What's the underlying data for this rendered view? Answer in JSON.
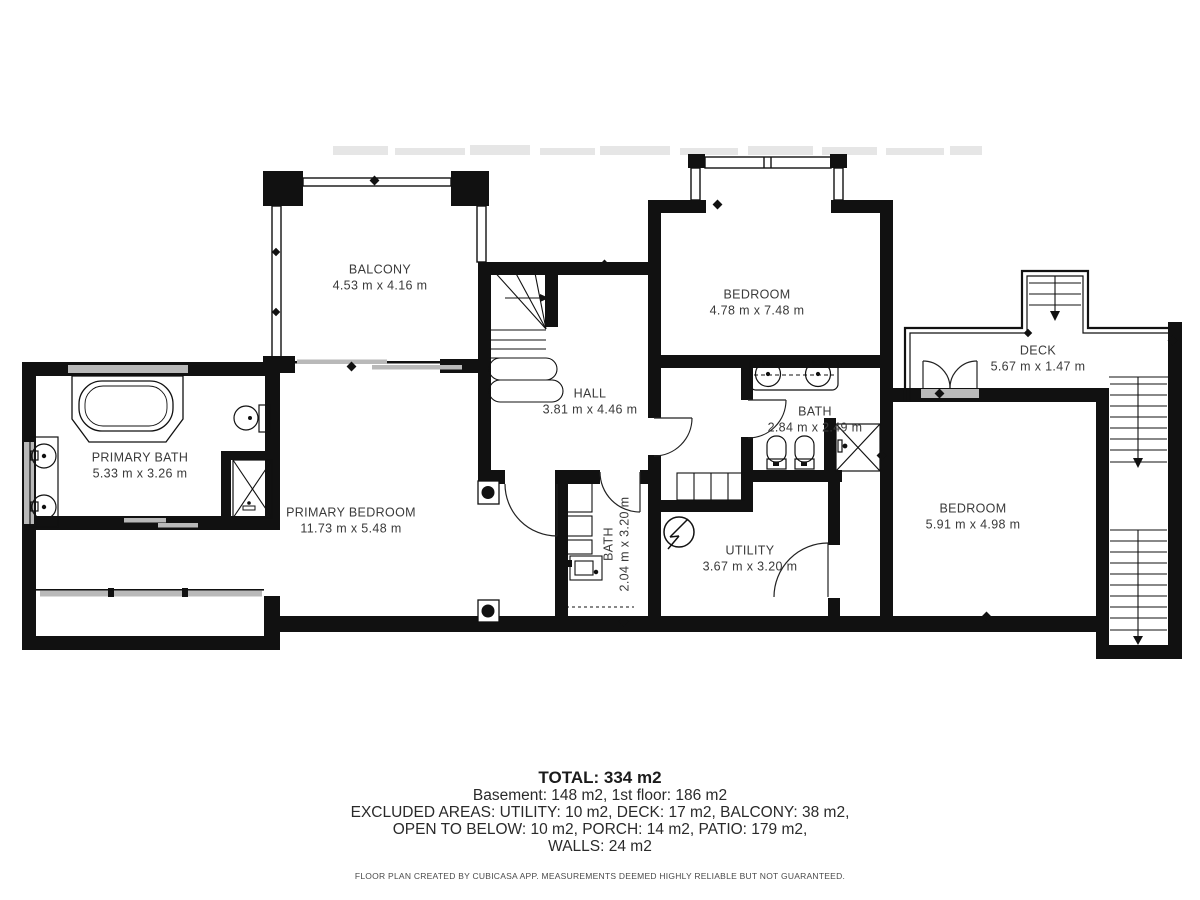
{
  "rooms": {
    "balcony": {
      "label": "BALCONY",
      "dims": "4.53 m x 4.16 m"
    },
    "hall": {
      "label": "HALL",
      "dims": "3.81 m x 4.46 m"
    },
    "bedroom_top": {
      "label": "BEDROOM",
      "dims": "4.78 m x 7.48 m"
    },
    "deck": {
      "label": "DECK",
      "dims": "5.67 m x 1.47 m"
    },
    "primary_bath": {
      "label": "PRIMARY BATH",
      "dims": "5.33 m x 3.26 m"
    },
    "primary_bedroom": {
      "label": "PRIMARY BEDROOM",
      "dims": "11.73 m x 5.48 m"
    },
    "bath": {
      "label": "BATH",
      "dims": "2.84 m x 2.49 m"
    },
    "bath_small": {
      "label": "BATH",
      "dims": "2.04 m x 3.20 m"
    },
    "utility": {
      "label": "UTILITY",
      "dims": "3.67 m x 3.20 m"
    },
    "bedroom_bottom": {
      "label": "BEDROOM",
      "dims": "5.91 m x 4.98 m"
    }
  },
  "summary": {
    "total": "TOTAL: 334 m2",
    "line1": "Basement: 148 m2, 1st floor: 186 m2",
    "line2": "EXCLUDED AREAS: UTILITY: 10 m2, DECK: 17 m2, BALCONY: 38 m2,",
    "line3": "OPEN TO BELOW: 10 m2, PORCH: 14 m2, PATIO: 179 m2,",
    "line4": "WALLS: 24 m2"
  },
  "attribution": "FLOOR PLAN CREATED BY CUBICASA APP. MEASUREMENTS DEEMED HIGHLY RELIABLE BUT NOT GUARANTEED.",
  "colors": {
    "wall": "#111111",
    "window_gray": "#b9b9b9",
    "text": "#3a3a3a"
  }
}
